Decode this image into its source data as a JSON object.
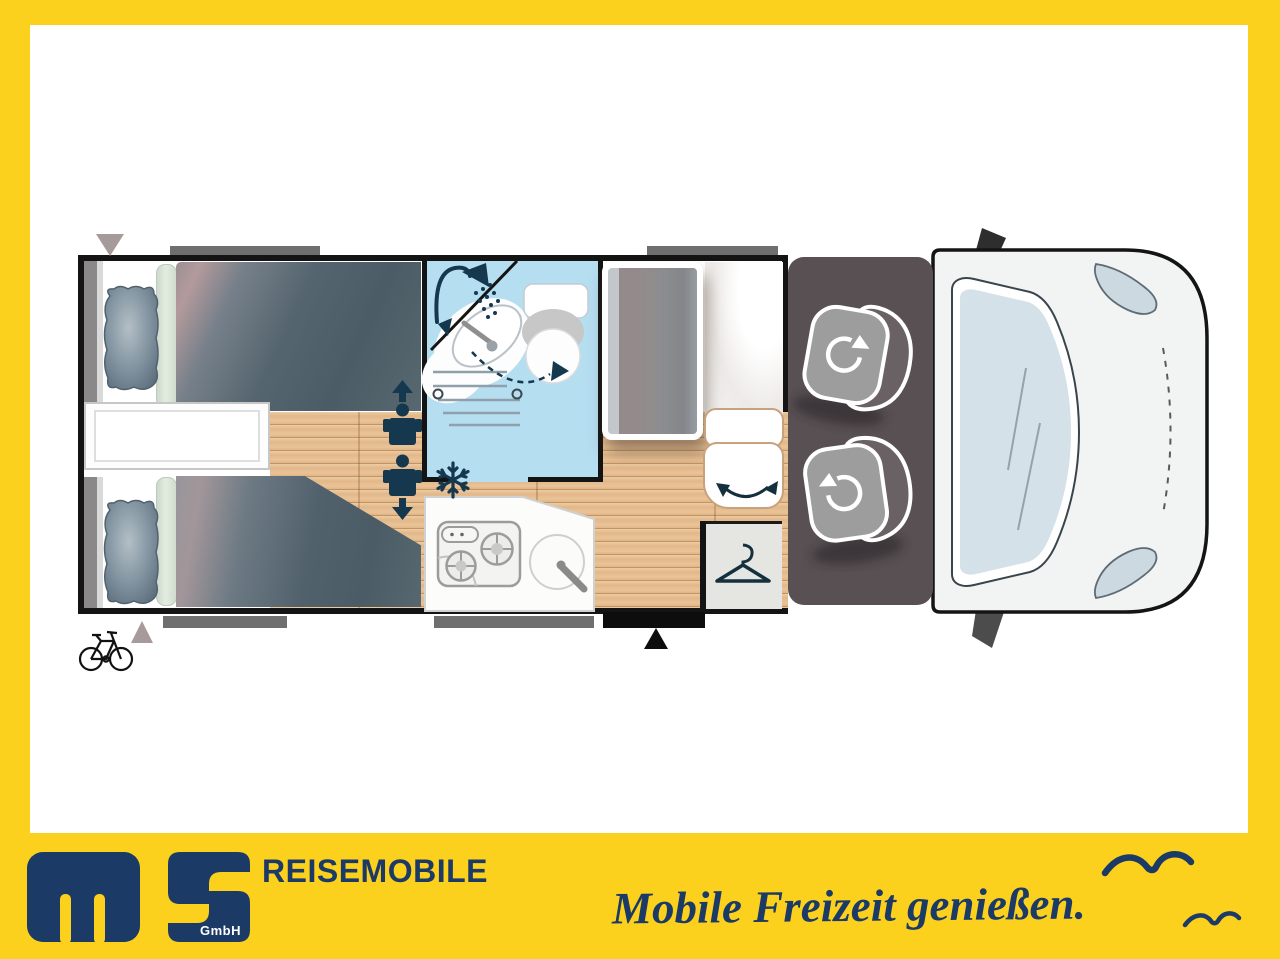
{
  "brand": {
    "title": "REISEMOBILE",
    "gmbh": "GmbH",
    "slogan": "Mobile Freizeit genießen."
  },
  "colors": {
    "frame_yellow": "#FCD11E",
    "brand_navy": "#1C3A66",
    "icon_navy": "#16384E",
    "bathroom_blue": "#B5DEF1",
    "wood_floor": "#E5BD92",
    "wall_black": "#141414",
    "duvet_slate": "#4E5E69",
    "cab_floor": "#585052",
    "seat_gray": "#9D9D9D",
    "van_body": "#F2F4F4",
    "windshield_glass": "#D4E1E9",
    "window_marker_gray": "#6F6F6F",
    "furniture_tan_outline": "#C8A17D"
  },
  "floorplan": {
    "areas": [
      "twin-single-beds",
      "bedside-step-chest",
      "washroom-with-swivel-wall",
      "kitchen-two-burner-hob-with-sink",
      "fridge-tv-cabinet",
      "wardrobe-with-hanger",
      "entry-door-with-step",
      "driver-cab-two-swivel-seats",
      "vehicle-front-with-windshield"
    ],
    "icons": [
      "shower-icon",
      "washbasin-icon",
      "toilet-icon",
      "swivel-wall-dashed-arrow-icon",
      "snowflake-fridge-icon",
      "berth-person-arrow-up-icon",
      "berth-person-arrow-down-icon",
      "door-swing-arrow-icon",
      "wardrobe-hanger-icon",
      "entry-triangle-marker",
      "bike-rack-icon",
      "seat-swivel-arrow-icon",
      "window-marker-bar",
      "awning-triangle-marker",
      "seagull-icon-large",
      "seagull-icon-small"
    ]
  }
}
